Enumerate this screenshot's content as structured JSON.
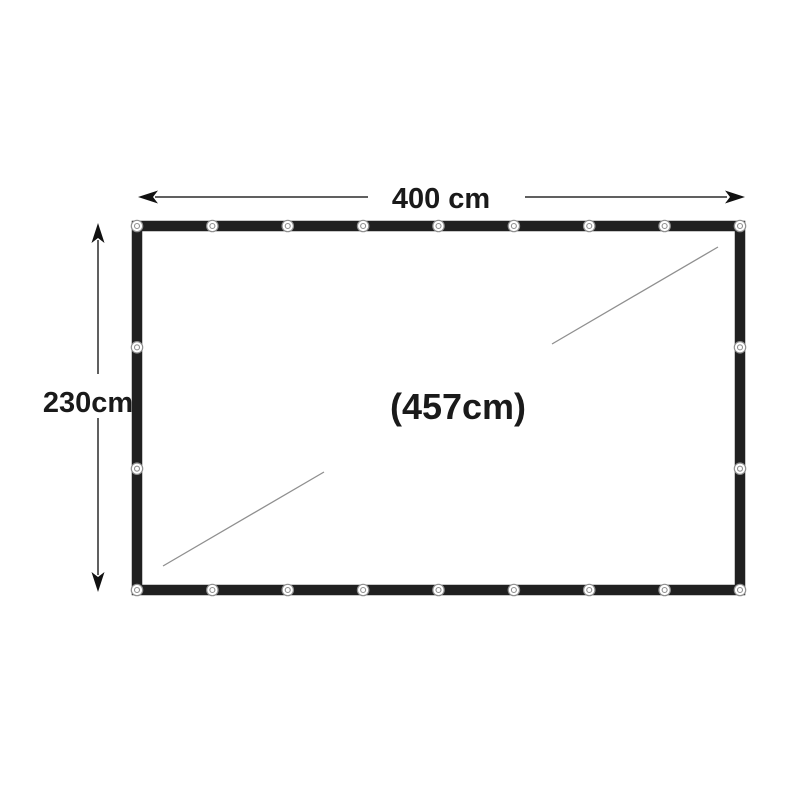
{
  "diagram": {
    "type": "tarp-dimension-diagram",
    "width_label": "400 cm",
    "height_label": "230cm",
    "diagonal_label": "(457cm)",
    "grommets": {
      "top_count": 9,
      "bottom_count": 9,
      "left_count": 4,
      "right_count": 4
    },
    "colors": {
      "background": "#ffffff",
      "tarp_border": "#202020",
      "tarp_fill": "#ffffff",
      "dimension_line": "#2b2b2b",
      "arrowhead": "#111111",
      "diagonal_line": "#8f8f8f",
      "label_text": "#1a1a1a",
      "grommet_fill": "#ffffff",
      "grommet_ring": "#909090"
    }
  }
}
